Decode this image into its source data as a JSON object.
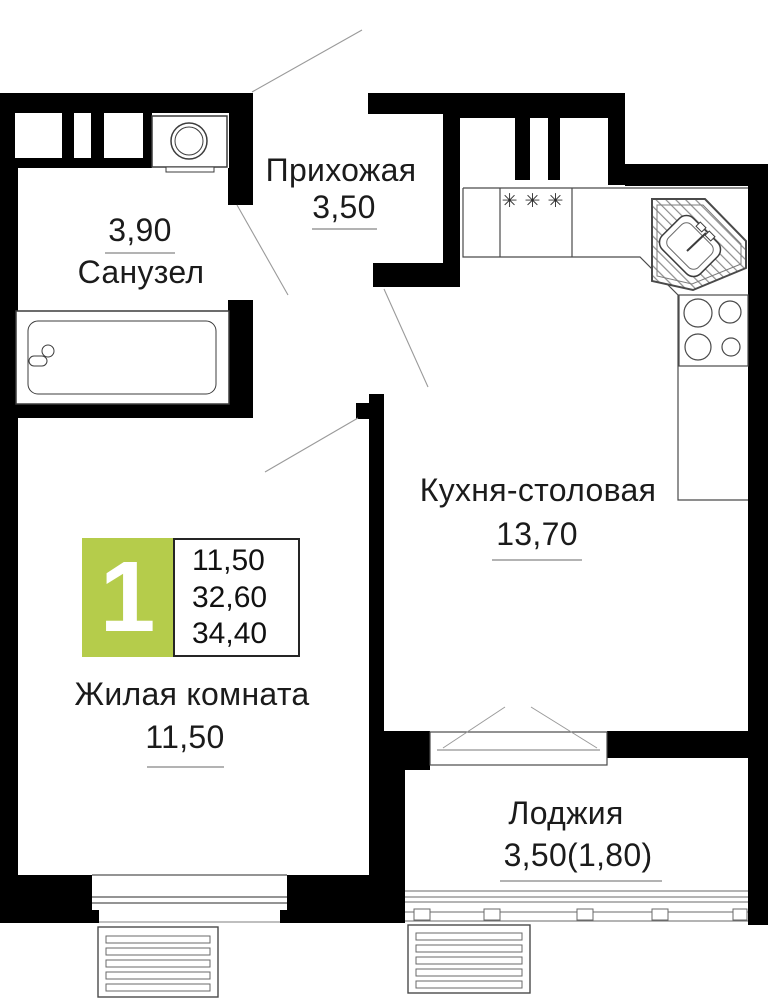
{
  "rooms": {
    "bathroom": {
      "area": "3,90",
      "name": "Санузел"
    },
    "hallway": {
      "name": "Прихожая",
      "area": "3,50"
    },
    "kitchen": {
      "name": "Кухня-столовая",
      "area": "13,70"
    },
    "living": {
      "name": "Жилая комната",
      "area": "11,50"
    },
    "loggia": {
      "name": "Лоджия",
      "area": "3,50(1,80)"
    }
  },
  "badge": {
    "room_count": "1",
    "lines": [
      "11,50",
      "32,60",
      "34,40"
    ]
  },
  "symbols": {
    "vent_marks": "✳✳✳"
  },
  "colors": {
    "badge_green": "#b5cc4b",
    "wall_black": "#000000",
    "thin_line_gray": "#9a9a9a"
  }
}
